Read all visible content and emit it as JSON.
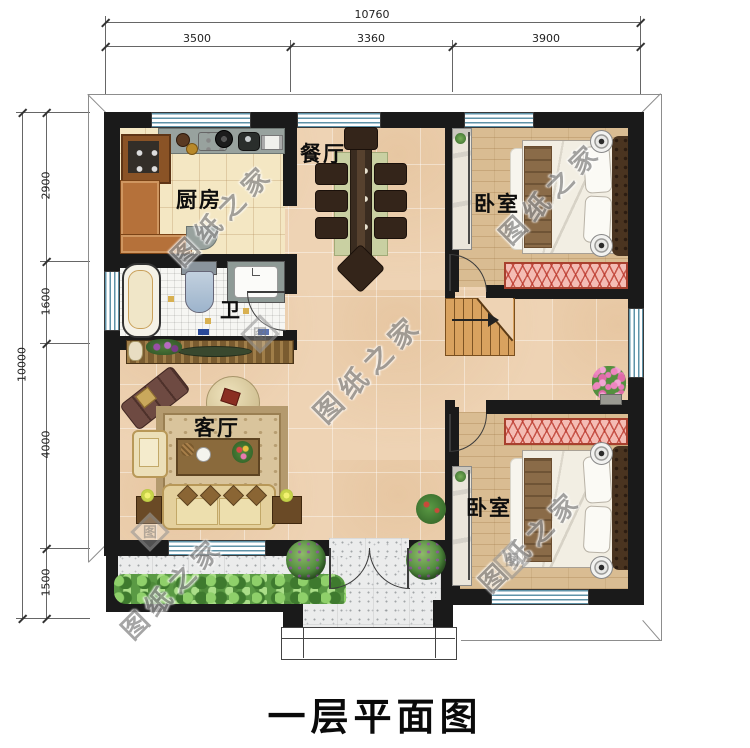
{
  "title": "一层平面图",
  "watermark": {
    "text": "图纸之家",
    "logo": "图"
  },
  "rooms": {
    "kitchen": "厨房",
    "dining": "餐厅",
    "bedroom_top": "卧室",
    "bath": "卫",
    "living": "客厅",
    "bedroom_bottom": "卧室"
  },
  "dimensions": {
    "top": {
      "total": "10760",
      "segments": [
        "3500",
        "3360",
        "3900"
      ]
    },
    "left": {
      "total": "10000",
      "segments": [
        "2900",
        "1600",
        "4000",
        "1500"
      ]
    }
  },
  "colors": {
    "wall": "#1a1a1a",
    "hall_floor": "#eed3b4",
    "kitchen_floor": "#f4e7c3",
    "bedroom_floor": "#d9bc92",
    "bath_floor": "#f6f6f3",
    "porch_floor": "#ebecec",
    "window_glass": "#5f93a8",
    "bench": "#f4bcb4"
  }
}
